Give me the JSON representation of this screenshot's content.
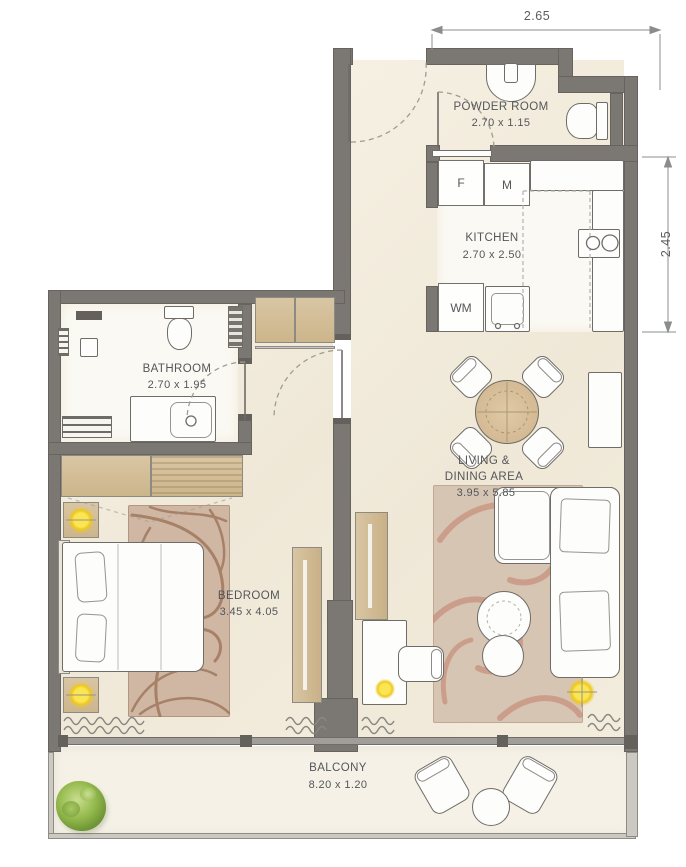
{
  "plan_type": "apartment-floor-plan",
  "rooms": {
    "powder": {
      "label": "POWDER ROOM",
      "size": "2.70 x 1.15"
    },
    "kitchen": {
      "label": "KITCHEN",
      "size": "2.70 x 2.50"
    },
    "bathroom": {
      "label": "BATHROOM",
      "size": "2.70 x 1.95"
    },
    "bedroom": {
      "label": "BEDROOM",
      "size": "3.45 x 4.05"
    },
    "living": {
      "label1": "LIVING &",
      "label2": "DINING AREA",
      "size": "3.95 x 5.85"
    },
    "balcony": {
      "label": "BALCONY",
      "size": "8.20 x 1.20"
    }
  },
  "appliances": {
    "fridge": "F",
    "microwave": "M",
    "washer": "WM"
  },
  "dimensions": {
    "top_width": "2.65",
    "right_height": "2.45"
  },
  "colors": {
    "wall": "#7b7874",
    "floor_cream": "#f3ecdd",
    "wood": "#d2bd97",
    "lamp_yellow": "#eec81d",
    "plant_green": "#87ae43",
    "bedroom_rug_swirl": "#9a6f53",
    "living_rug_swirl": "#c3806a",
    "text": "#54565a"
  }
}
